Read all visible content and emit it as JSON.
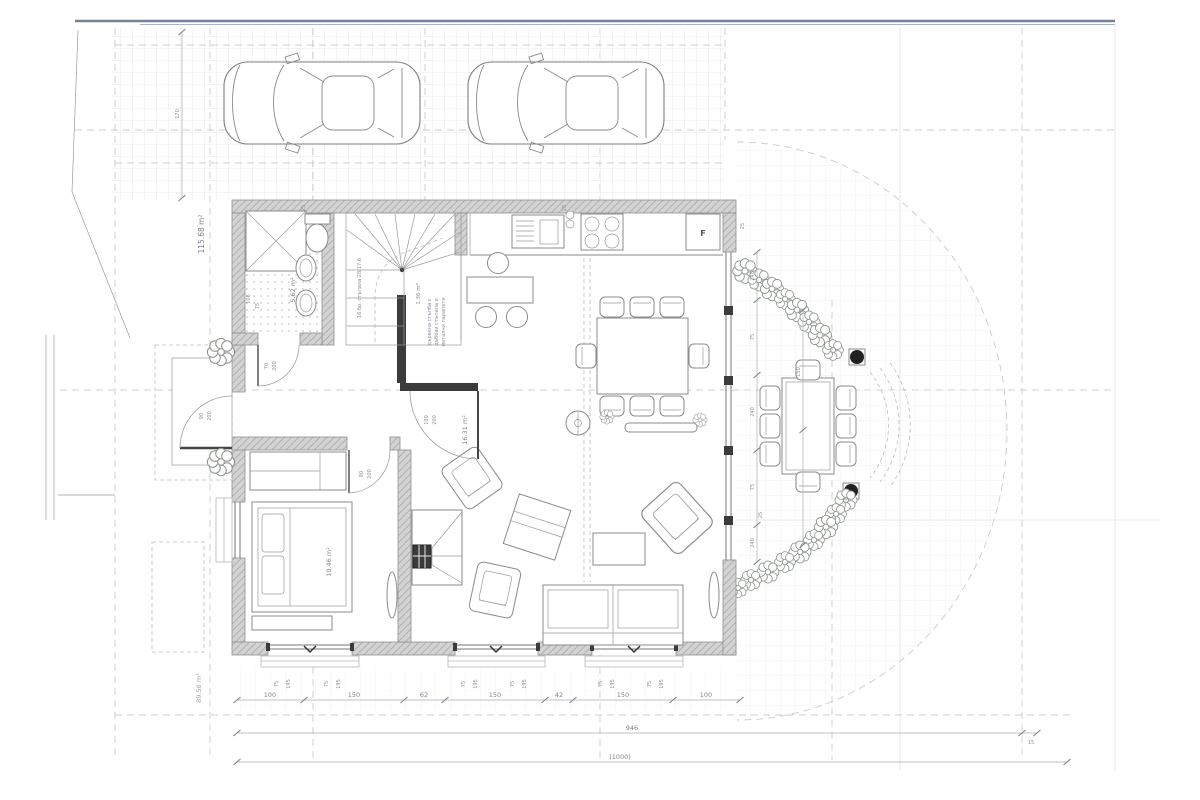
{
  "drawing": {
    "kind": "ground floor architectural plan with driveway, two cars and round garden terrace"
  },
  "areas": {
    "site": "115.68 m²",
    "bath": "5.62 m²",
    "stair": "1.36 m²",
    "bedroom": "10.46 m²",
    "hall": "16.31 m²",
    "garden": "89.58 m²"
  },
  "labels": {
    "fridge": "F"
  },
  "doors": {
    "entrance": [
      "90",
      "200"
    ],
    "bath": [
      "70",
      "200"
    ],
    "bedroom": [
      "80",
      "200"
    ],
    "living": [
      "100",
      "200"
    ]
  },
  "dims": {
    "run": [
      "100",
      "150",
      "62",
      "150",
      "42",
      "150",
      "100"
    ],
    "total": "946",
    "overall": "(1000)",
    "offset": "15",
    "left": "170",
    "jamb": "75",
    "win": "195",
    "wall": "25",
    "col": "240",
    "gap": "75",
    "terr": "150",
    "bath_side": [
      "106",
      "75"
    ]
  },
  "notes": {
    "stair": "16 бр. стъпала 28/17.6",
    "n1": "дървена стълба с",
    "n2": "дъбови стъпала и",
    "n3": "метални парапети"
  }
}
